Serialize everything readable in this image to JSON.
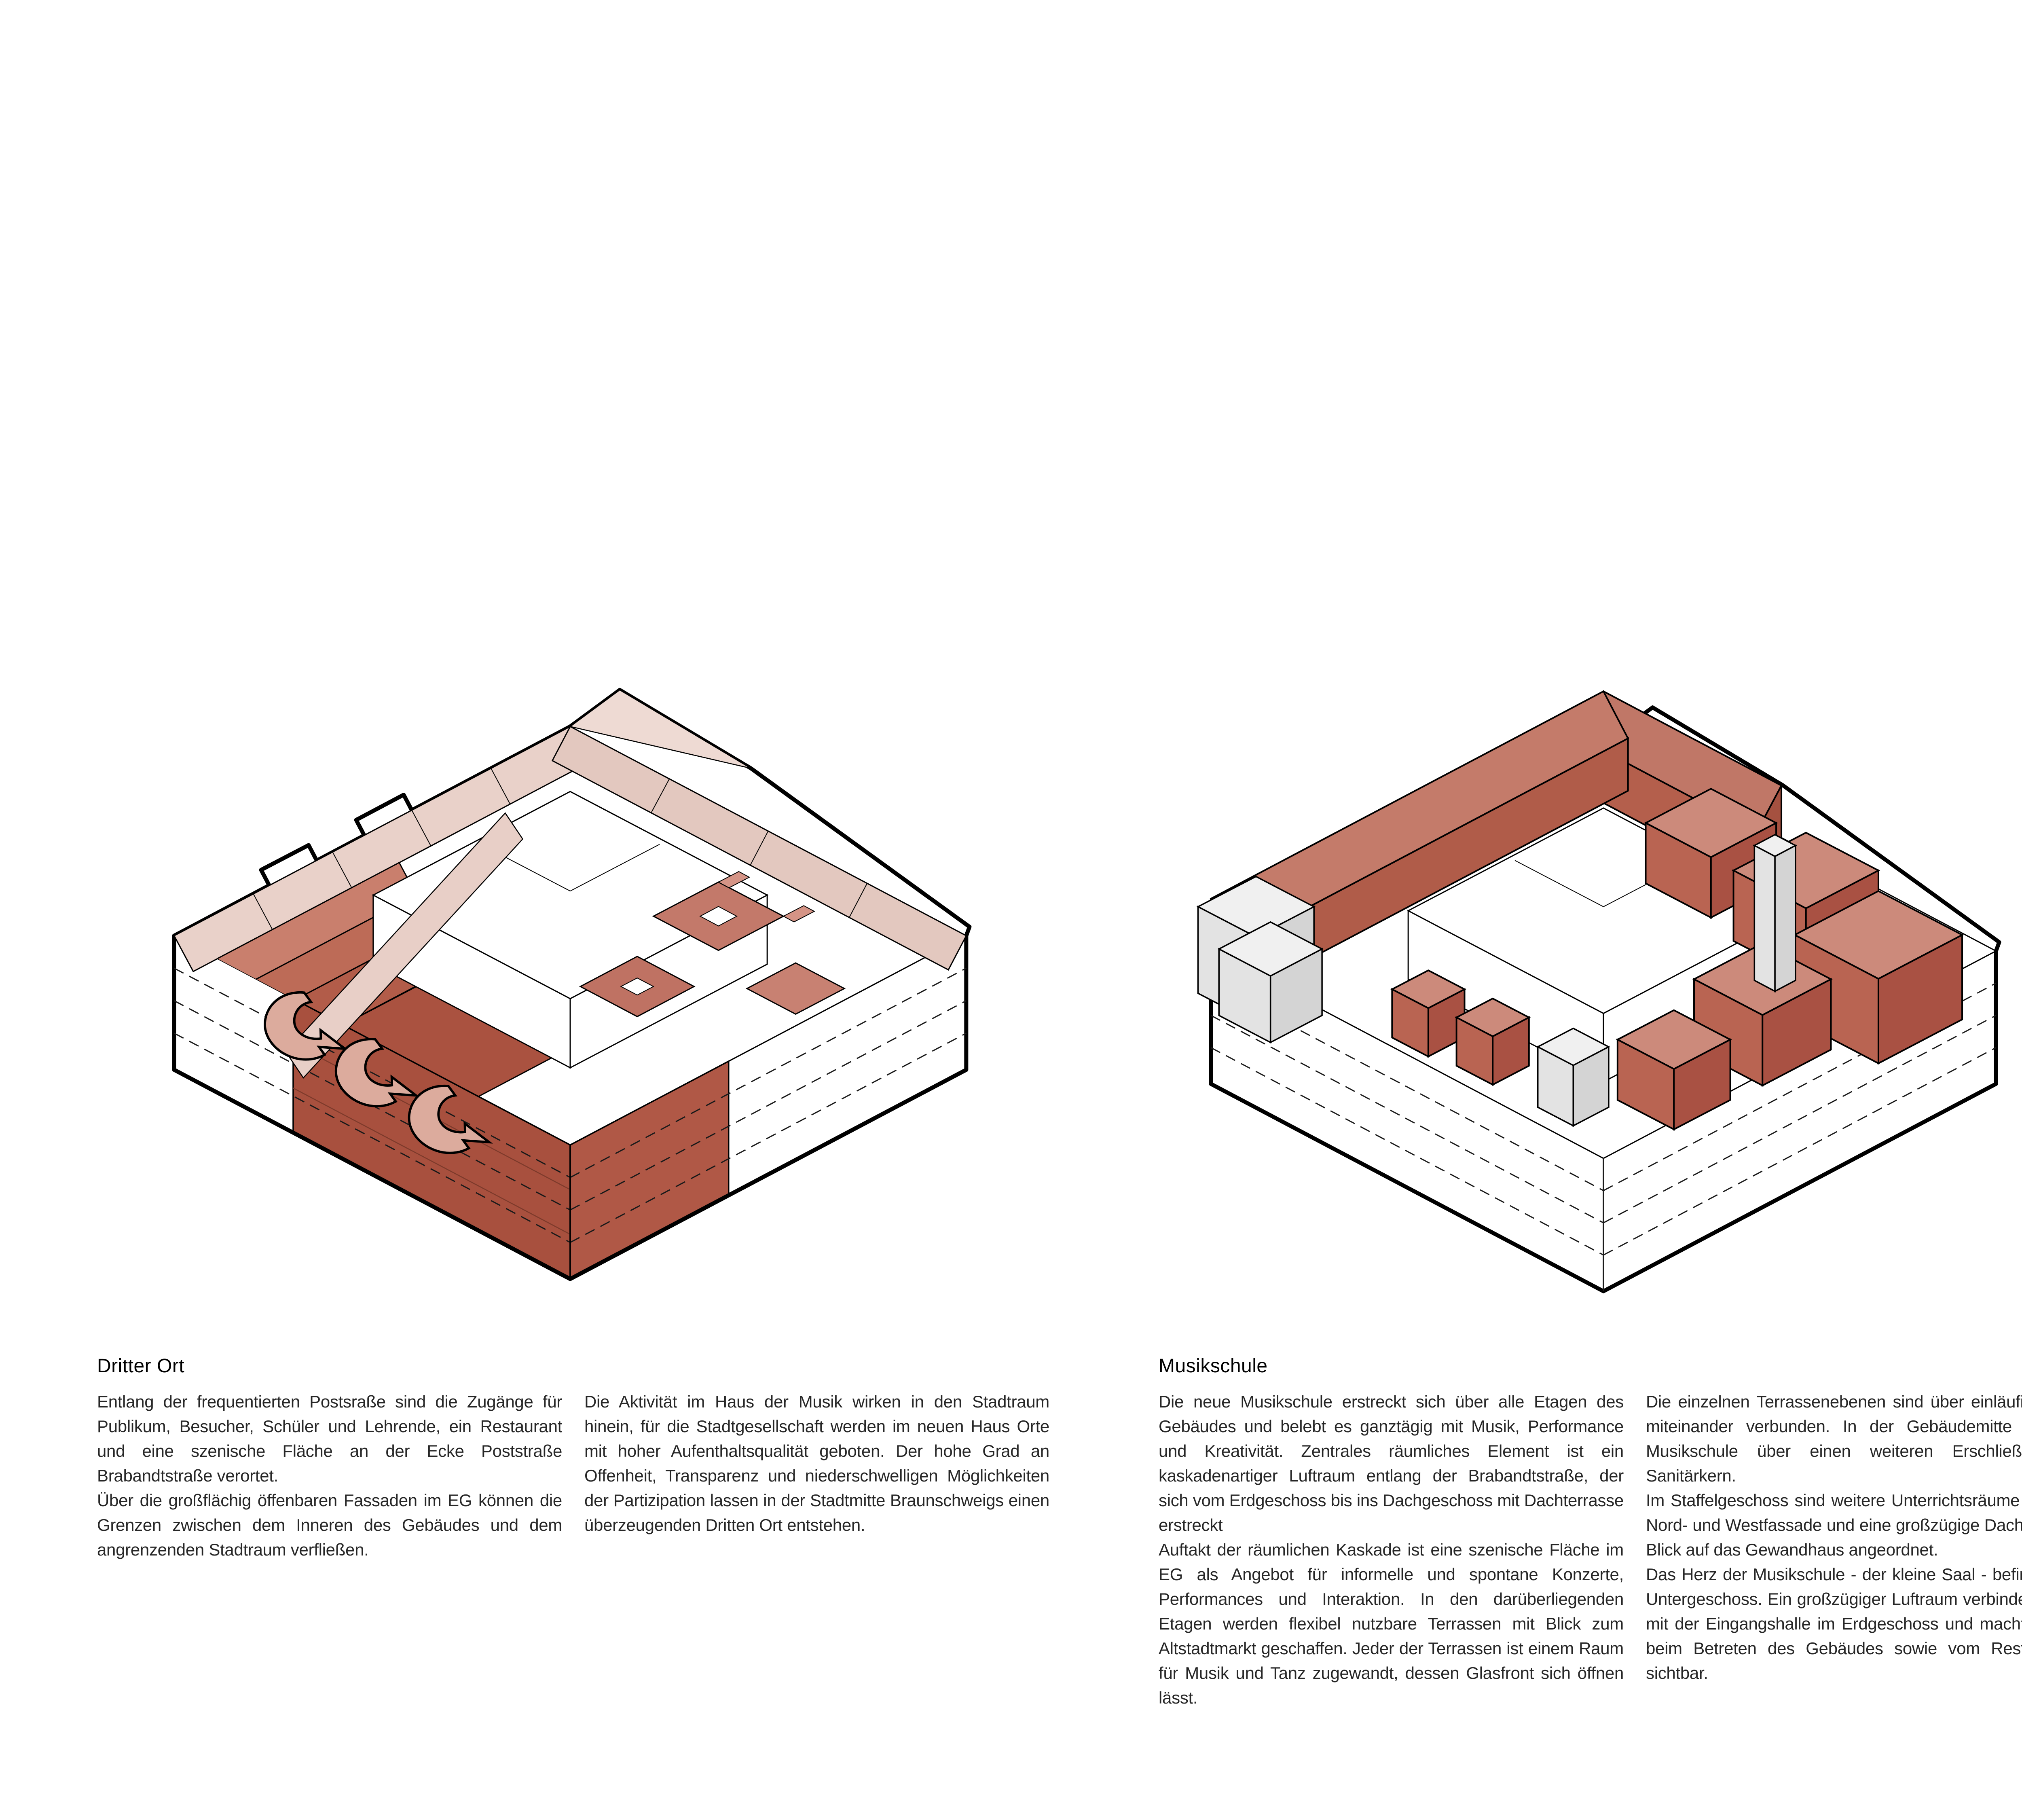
{
  "page": {
    "background": "#ffffff",
    "text_color": "#262626",
    "heading_color": "#000000"
  },
  "palette": {
    "red_dark": "#a8503e",
    "red_mid": "#bc6a57",
    "red_top": "#cc8a7b",
    "red_light": "#d69a8d",
    "pink_band": "#e9d1c9",
    "grey_light": "#f0f0f0",
    "grey_mid": "#d4d4d4",
    "outline": "#000000"
  },
  "sections": [
    {
      "id": "dritter-ort",
      "title": "Dritter Ort",
      "diagram": "axonometric-circulation-diagram",
      "columns": [
        [
          "Entlang der frequentierten Postsraße sind die Zugänge für Publikum, Besucher, Schüler und Lehrende, ein Restaurant und eine szenische Fläche an der Ecke Poststraße Brabandtstraße verortet.",
          "Über die großflächig öffenbaren Fassaden im EG können die Grenzen zwischen dem Inneren des Gebäudes und dem angrenzenden Stadtraum verfließen."
        ],
        [
          "Die Aktivität im Haus der Musik wirken in den Stadtraum hinein, für die Stadtgesellschaft werden im neuen Haus Orte mit hoher Aufenthaltsqualität geboten. Der hohe Grad an Offenheit, Transparenz und niederschwelligen Möglichkeiten der Partizipation lassen in der Stadtmitte Braunschweigs einen überzeugenden Dritten Ort entstehen."
        ]
      ]
    },
    {
      "id": "musikschule",
      "title": "Musikschule",
      "diagram": "axonometric-musikschule-diagram",
      "columns": [
        [
          "Die neue Musikschule erstreckt sich über alle Etagen des Gebäudes und belebt es ganztägig mit Musik, Performance und Kreativität. Zentrales räumliches Element ist ein kaskadenartiger Luftraum entlang der Brabandtstraße, der sich vom Erdgeschoss bis ins Dachgeschoss mit Dachterrasse erstreckt",
          "Auftakt der räumlichen Kaskade ist eine szenische Fläche im EG als Angebot für informelle und spontane Konzerte, Performances und Interaktion. In den darüberliegenden Etagen werden flexibel nutzbare Terrassen mit Blick zum Altstadtmarkt geschaffen. Jeder der Terrassen ist einem Raum für Musik und Tanz zugewandt, dessen Glasfront sich öffnen lässt."
        ],
        [
          "Die einzelnen Terrassenebenen sind über einläufige Treppen miteinander verbunden. In der Gebäudemitte verfügt die Musikschule über einen weiteren Erschließungs- und Sanitärkern.",
          "Im Staffelgeschoss sind weitere Unterrichtsräume entlang der Nord- und Westfassade und eine großzügige Dachterrasse mit Blick auf das Gewandhaus angeordnet.",
          "Das Herz der Musikschule - der kleine Saal - befindet sich im Untergeschoss. Ein großzügiger Luftraum verbindet ihn visuell mit der Eingangshalle im Erdgeschoss und macht ihn bereits beim Betreten des Gebäudes sowie vom Restaurant aus sichtbar."
        ]
      ]
    },
    {
      "id": "konzertsaal",
      "title": "Konzertsaal",
      "diagram": "axonometric-konzertsaal-diagram",
      "columns": [
        [
          "Der Große Konzertsaal wird als Raum-in-Raum Konstruktion in die bestehende Tragstruktur Bestand integriert. Die Kubatur des neuen Saales wird aus massiven, ca. 30cm starken Brettsperrholzelementen gefügt. Durch die aus akustischer Sicht einschalige und gleichzeitig verwindungssteife Wand- und Deckenkonstruktion des neuen Saales wird der Schall vielfach reflektiert. Es wird ein Nachhall mit hohem energetischem Niveau bei mittlerer Nachhallzeit erreicht. Das Zusammenspiel von Konstruktion, Volumen und Sitzverteilung bieten für die Konzertsaalakustik eine hohe Klarheit und einen sehr guten räumlichen Höreindruck."
        ],
        [
          "Alle Plätze im Saal bieten optimale Sicht- und Hörbedingungen in Bezug zur szenischen Fläche.",
          "Die Garderobe für die Konzertbesucher befindet sich im ersten Obergeschoss unterhalb des ansteigenden Parketts des Konzertsaales. Theken und Sanitäranlagen sind dezentral über die Geschosse verteilt an der Ostseite der Foyers angeordnet.",
          "In den Obergeschossen wird der Konzertsaal auf drei Seiten - im Westen, Süden und Osten - von den Künstler- und Backstagebereichen umschlossen. Der separate Künstlereingang sowie die Anlieferung befinden sich im Erdgeschoss an der Brabandtstraße."
        ]
      ]
    }
  ]
}
